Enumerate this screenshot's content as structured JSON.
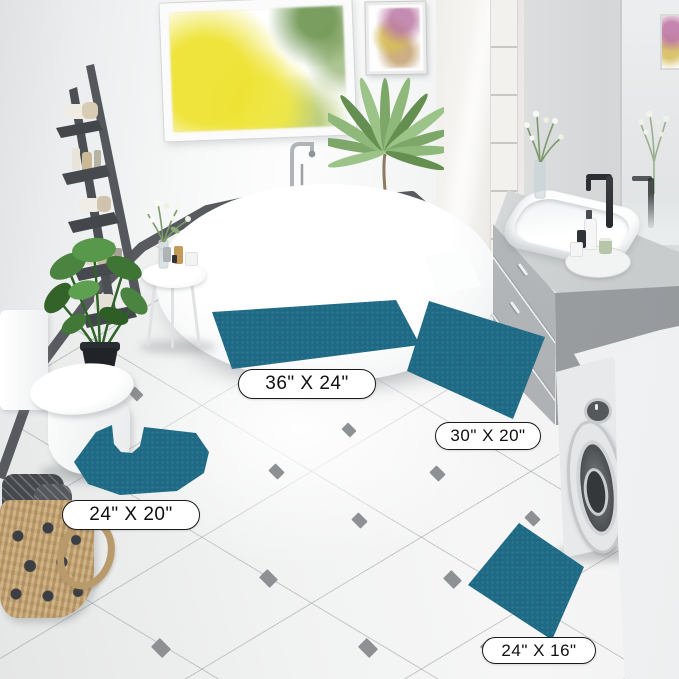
{
  "labels": {
    "mat_36x24": "36\" X 24\"",
    "mat_30x20": "30\" X 20\"",
    "mat_24x20": "24\" X 20\"",
    "mat_24x16": "24\" X 16\""
  },
  "colors": {
    "rug_teal": "#1e6a85",
    "floor_diamond_gray": "#8d9193",
    "label_border": "#1a1a1a"
  }
}
